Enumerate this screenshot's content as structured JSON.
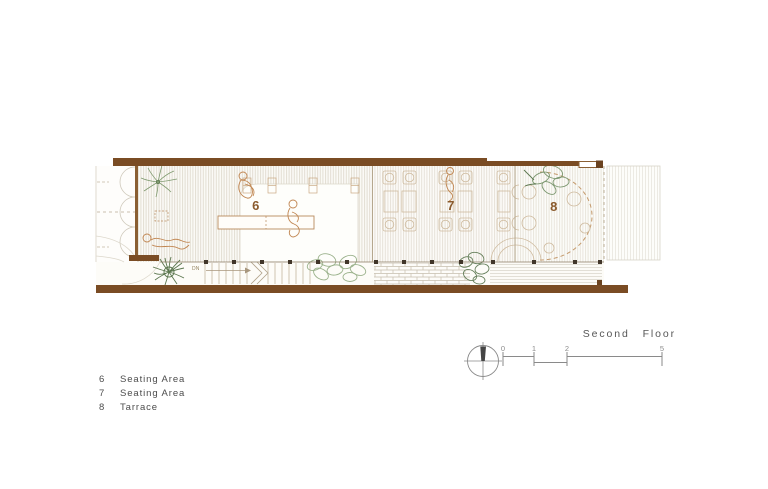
{
  "title": "Second Floor",
  "legend": {
    "items": [
      {
        "number": "6",
        "label": "Seating Area"
      },
      {
        "number": "7",
        "label": "Seating Area"
      },
      {
        "number": "8",
        "label": "Tarrace"
      }
    ]
  },
  "plan": {
    "room_labels": [
      {
        "number": "6",
        "name": "Seating Area"
      },
      {
        "number": "7",
        "name": "Seating Area"
      },
      {
        "number": "8",
        "name": "Tarrace"
      }
    ],
    "stairs_label": "DN"
  },
  "scale_bar": {
    "ticks": [
      "0",
      "1",
      "2",
      "5"
    ],
    "unit_hint": "meters"
  },
  "icons": {
    "north_indicator": "north-arrow-icon"
  },
  "colors": {
    "wall_brown": "#7a4c24",
    "wall_brown_dark": "#6b4320",
    "room_number": "#8a5a2c",
    "people_outline": "#c08550",
    "plant_light": "#9bb28c",
    "plant_dark": "#5c774f",
    "annotation_gray": "#8c8c8c",
    "text_gray": "#4c4c4c"
  }
}
